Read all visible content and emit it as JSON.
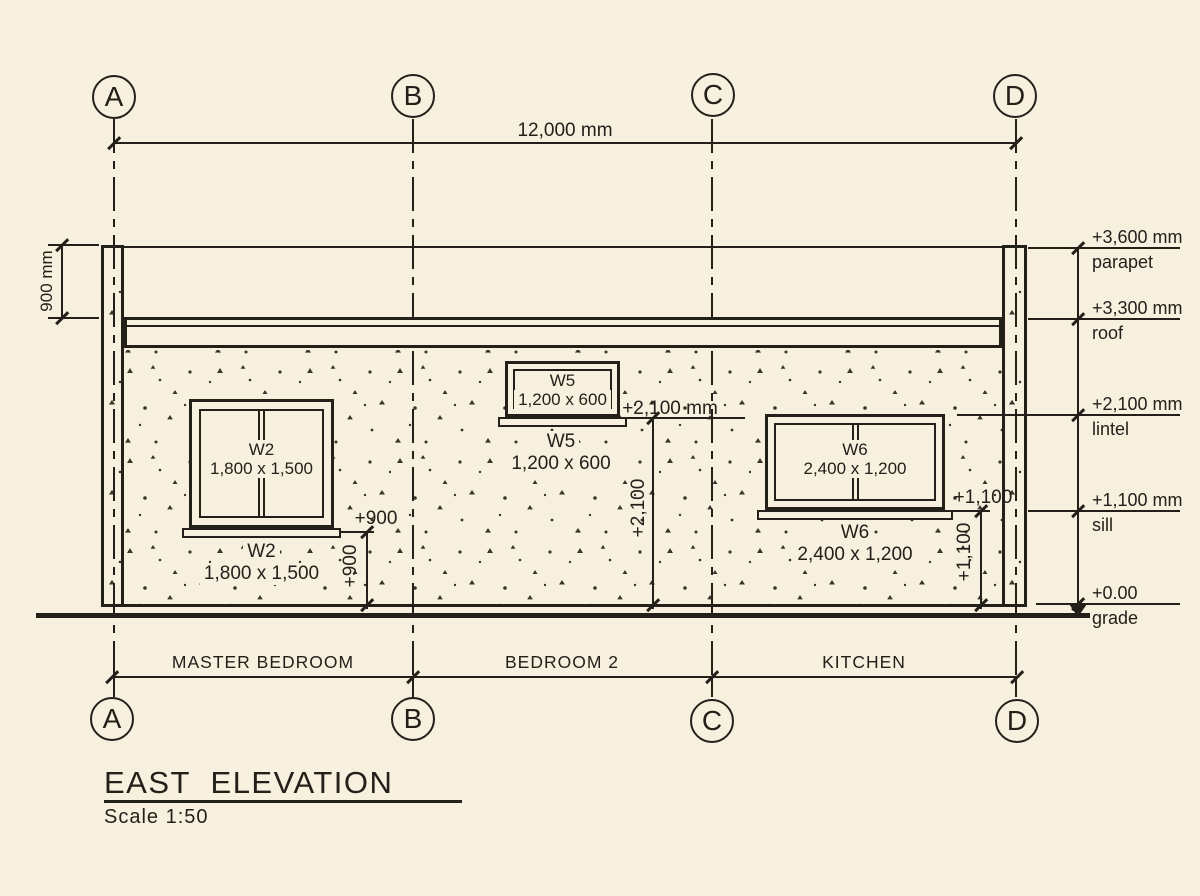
{
  "drawing": {
    "title": "EAST  ELEVATION",
    "scale": "Scale  1:50"
  },
  "grid": {
    "letters": [
      "A",
      "B",
      "C",
      "D"
    ]
  },
  "dims": {
    "overall_width": "12,000 mm",
    "parapet_height": "900 mm",
    "sill_w2_h": "+900",
    "sill_w2_v": "+900",
    "lintel_h": "+2,100 mm",
    "lintel_v": "+2,100",
    "sill_w6_h": "+1,100",
    "sill_w6_v": "+1,100"
  },
  "levels": [
    {
      "value": "+3,600 mm",
      "name": "parapet"
    },
    {
      "value": "+3,300 mm",
      "name": "roof"
    },
    {
      "value": "+2,100 mm",
      "name": "lintel"
    },
    {
      "value": "+1,100 mm",
      "name": "sill"
    },
    {
      "value": "+0.00",
      "name": "grade"
    }
  ],
  "windows": [
    {
      "id": "W2",
      "size": "1,800 x 1,500"
    },
    {
      "id": "W5",
      "size": "1,200 x 600"
    },
    {
      "id": "W6",
      "size": "2,400 x 1,200"
    }
  ],
  "rooms": [
    "MASTER BEDROOM",
    "BEDROOM 2",
    "KITCHEN"
  ],
  "colors": {
    "background": "#f7f0df",
    "line": "#23201a"
  }
}
